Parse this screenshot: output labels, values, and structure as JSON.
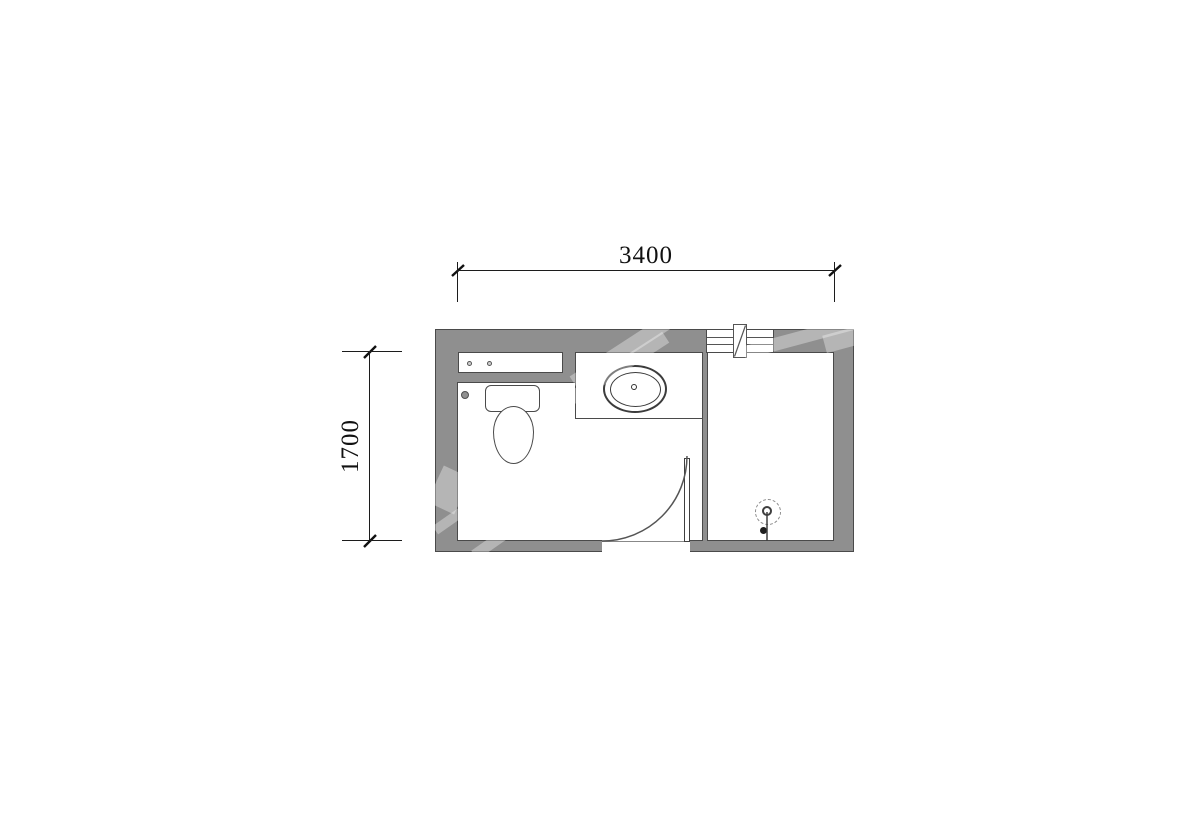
{
  "page": {
    "background": "#ffffff"
  },
  "drawing": {
    "type": "floor-plan",
    "subject": "bathroom plan view with dimensions",
    "dimensions": {
      "width_mm": "3400",
      "height_mm": "1700"
    },
    "fixtures": [
      "shelf-niche",
      "toilet",
      "water-supply-valve",
      "vanity-counter-with-oval-sink",
      "swing-door",
      "casement-window",
      "partition-wall",
      "shower-head-symbol"
    ],
    "colors": {
      "wall_fill": "#8f8f8f",
      "wall_line": "#4a4a4a",
      "fixture_line": "#555555",
      "dimension_line": "#1c1c1c",
      "watermark": "rgba(255,255,255,0.34)"
    }
  }
}
